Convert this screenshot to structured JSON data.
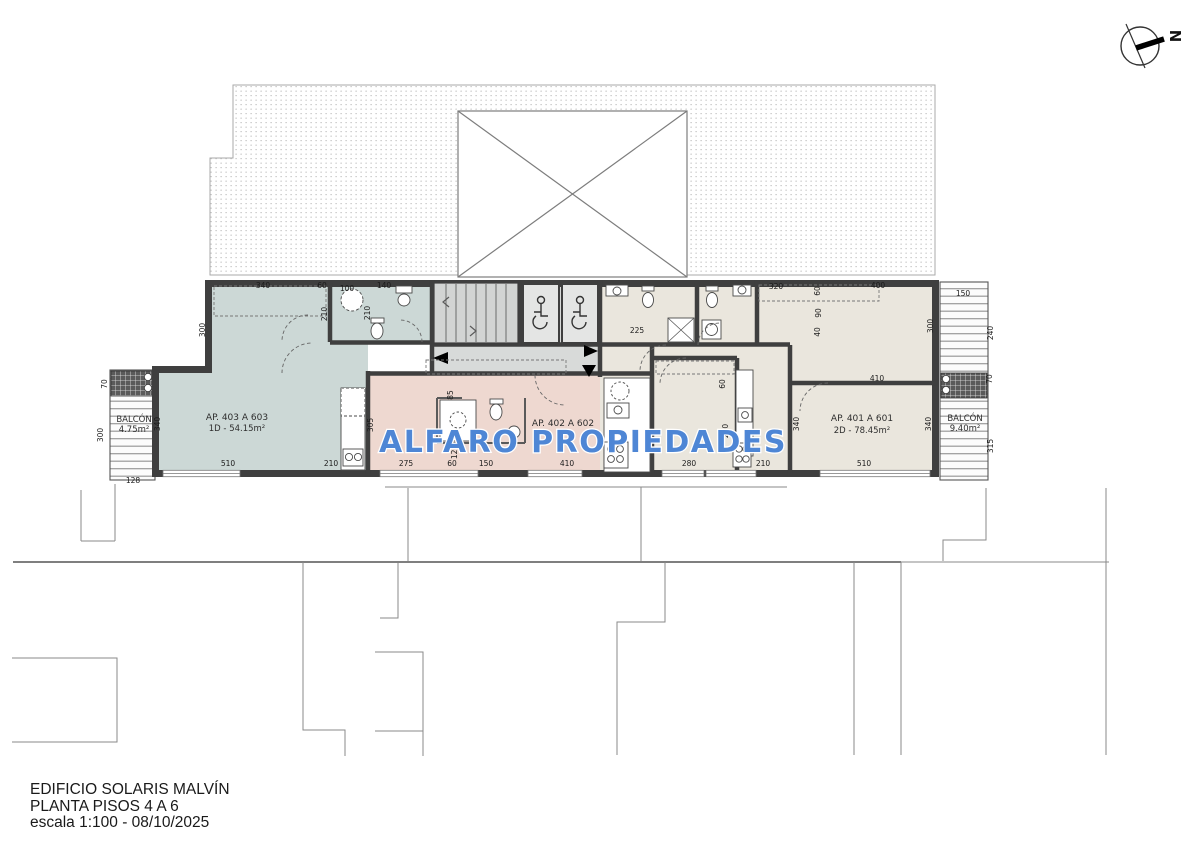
{
  "north": {
    "label": "N"
  },
  "watermark": {
    "text": "ALFARO PROPIEDADES",
    "color": "#4e86d5"
  },
  "title_block": {
    "building": "EDIFICIO SOLARIS MALVÍN",
    "plan": "PLANTA PISOS 4 A 6",
    "scale_line": "escala 1:100 - 08/10/2025"
  },
  "apartments": [
    {
      "name": "AP. 403 A 603",
      "detail": "1D - 54.15m²",
      "color": "#ccd8d6"
    },
    {
      "name": "AP. 402 A 602",
      "detail": "",
      "color": "#eed8d0"
    },
    {
      "name": "AP. 401 A 601",
      "detail": "2D - 78.45m²",
      "color": "#eae6dd"
    }
  ],
  "balconies": [
    {
      "label": "BALCÓN",
      "area": "4.75m²"
    },
    {
      "label": "BALCÓN",
      "area": "9.40m²"
    }
  ],
  "colors": {
    "wall": "#3f3f3f",
    "common_area": "#d8dad9",
    "apartment_403": "#ccd8d6",
    "apartment_402": "#eed8d0",
    "apartment_401": "#eae6dd",
    "watermark": "#4e86d5"
  },
  "plan": {
    "dimensions": [
      {
        "v": "340",
        "x": 263,
        "y": 288,
        "o": "h"
      },
      {
        "v": "60",
        "x": 322,
        "y": 288,
        "o": "h"
      },
      {
        "v": "100",
        "x": 347,
        "y": 291,
        "o": "h"
      },
      {
        "v": "140",
        "x": 384,
        "y": 288,
        "o": "h"
      },
      {
        "v": "225",
        "x": 637,
        "y": 333,
        "o": "h"
      },
      {
        "v": "320",
        "x": 776,
        "y": 289,
        "o": "h"
      },
      {
        "v": "400",
        "x": 878,
        "y": 288,
        "o": "h"
      },
      {
        "v": "410",
        "x": 877,
        "y": 381,
        "o": "h"
      },
      {
        "v": "150",
        "x": 963,
        "y": 296,
        "o": "h"
      },
      {
        "v": "128",
        "x": 133,
        "y": 483,
        "o": "h"
      },
      {
        "v": "510",
        "x": 228,
        "y": 466,
        "o": "h"
      },
      {
        "v": "210",
        "x": 331,
        "y": 466,
        "o": "h"
      },
      {
        "v": "275",
        "x": 406,
        "y": 466,
        "o": "h"
      },
      {
        "v": "60",
        "x": 452,
        "y": 466,
        "o": "h"
      },
      {
        "v": "150",
        "x": 486,
        "y": 466,
        "o": "h"
      },
      {
        "v": "410",
        "x": 567,
        "y": 466,
        "o": "h"
      },
      {
        "v": "280",
        "x": 689,
        "y": 466,
        "o": "h"
      },
      {
        "v": "210",
        "x": 763,
        "y": 466,
        "o": "h"
      },
      {
        "v": "510",
        "x": 864,
        "y": 466,
        "o": "h"
      },
      {
        "v": "300",
        "x": 205,
        "y": 330,
        "o": "v"
      },
      {
        "v": "210",
        "x": 327,
        "y": 314,
        "o": "v"
      },
      {
        "v": "210",
        "x": 370,
        "y": 313,
        "o": "v"
      },
      {
        "v": "60",
        "x": 820,
        "y": 291,
        "o": "v"
      },
      {
        "v": "90",
        "x": 821,
        "y": 313,
        "o": "v"
      },
      {
        "v": "40",
        "x": 820,
        "y": 332,
        "o": "v"
      },
      {
        "v": "300",
        "x": 933,
        "y": 326,
        "o": "v"
      },
      {
        "v": "240",
        "x": 993,
        "y": 333,
        "o": "v"
      },
      {
        "v": "70",
        "x": 992,
        "y": 379,
        "o": "v"
      },
      {
        "v": "315",
        "x": 993,
        "y": 446,
        "o": "v"
      },
      {
        "v": "70",
        "x": 107,
        "y": 384,
        "o": "v"
      },
      {
        "v": "300",
        "x": 103,
        "y": 435,
        "o": "v"
      },
      {
        "v": "340",
        "x": 160,
        "y": 424,
        "o": "v"
      },
      {
        "v": "305",
        "x": 373,
        "y": 425,
        "o": "v"
      },
      {
        "v": "85",
        "x": 453,
        "y": 395,
        "o": "v"
      },
      {
        "v": "120",
        "x": 457,
        "y": 452,
        "o": "v"
      },
      {
        "v": "60",
        "x": 725,
        "y": 384,
        "o": "v"
      },
      {
        "v": "280",
        "x": 728,
        "y": 431,
        "o": "v"
      },
      {
        "v": "340",
        "x": 799,
        "y": 424,
        "o": "v"
      },
      {
        "v": "340",
        "x": 931,
        "y": 424,
        "o": "v"
      }
    ]
  }
}
